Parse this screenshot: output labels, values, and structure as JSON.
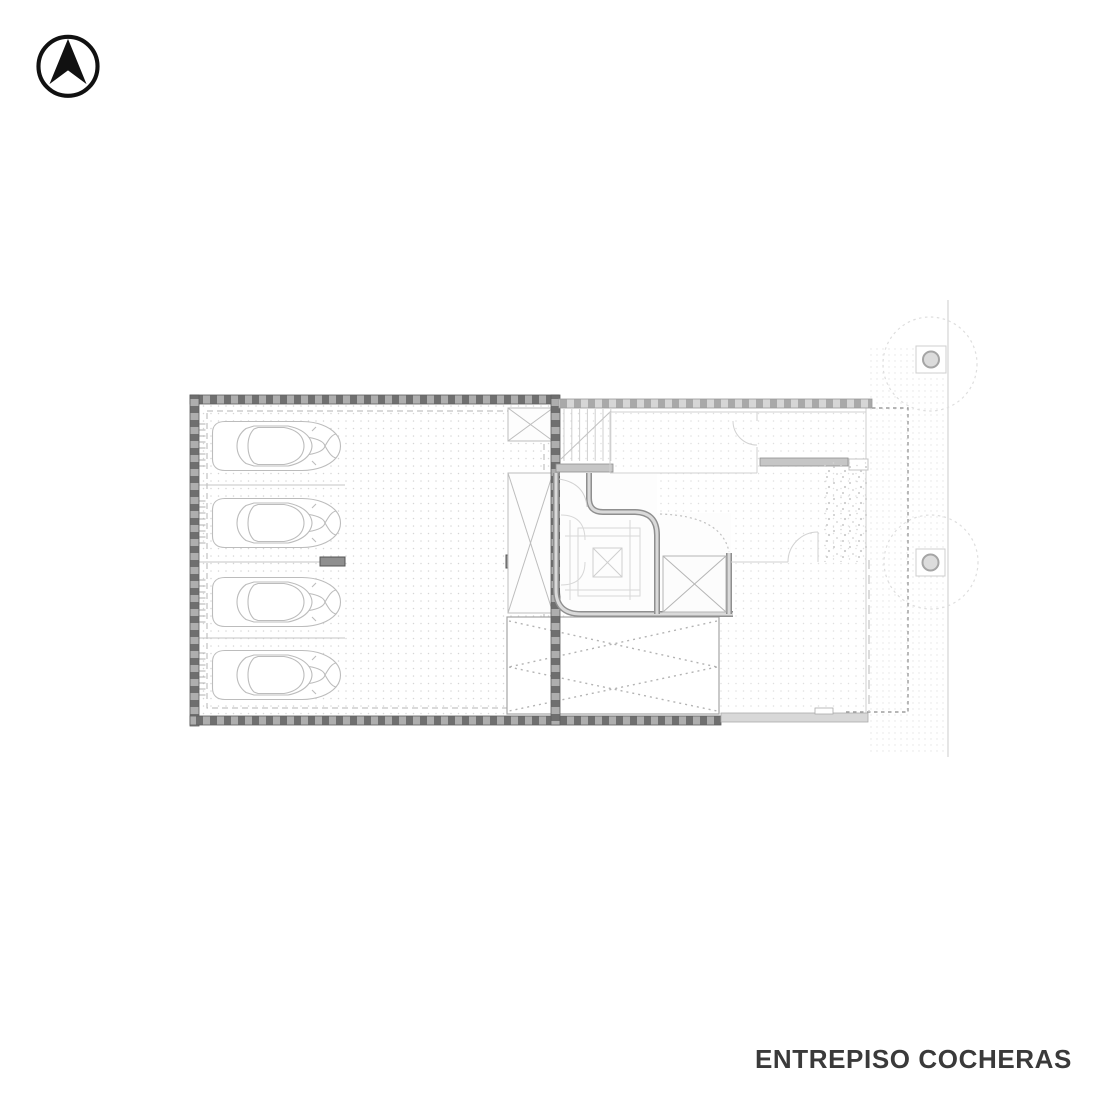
{
  "footer": {
    "title": "ENTREPISO COCHERAS"
  },
  "icons": {
    "north_arrow": "north-arrow-icon"
  },
  "colors": {
    "wall_fill": "#aeaeae",
    "wall_hatch": "#6f6f6f",
    "wall_light_fill": "#d6d6d6",
    "wall_light_hatch": "#a9a9a9",
    "wall_outline": "#5e5e5e",
    "core_wall": "#8f8f8f",
    "core_wall_inner": "#dadada",
    "faint_line": "#d2d2d2",
    "medium_line": "#b3b3b3",
    "car_line": "#bcbcbc",
    "grid_dot": "#d6d6d6",
    "grid_dot_light": "#e0e0e0",
    "grid_dot_fine": "#e4e4e4",
    "dashed_boundary": "#9d9d9d",
    "column_fill": "#8f8f8f",
    "title_color": "#3a3a3a",
    "icon_color": "#111111"
  },
  "plan": {
    "cars": {
      "count": 4,
      "x": 210,
      "ys": [
        420,
        497,
        576,
        649
      ]
    },
    "stall_dividers_y": [
      485,
      562,
      638
    ],
    "stall_line": {
      "x1": 198,
      "x2": 345
    },
    "wall_ticks": {
      "x1": 199,
      "x2": 205.5,
      "step": 6,
      "span": 46,
      "offset": 4
    },
    "stair_upper_treads": {
      "x_start": 564,
      "x_end": 611,
      "step": 7.8,
      "y1": 409,
      "y2": 461
    },
    "trees": [
      {
        "cx": 930,
        "cy": 364,
        "r": 47
      },
      {
        "cx": 931,
        "cy": 562,
        "r": 47
      }
    ],
    "posts": [
      {
        "x": 916,
        "y": 346,
        "w": 30,
        "h": 27
      },
      {
        "x": 916,
        "y": 549,
        "w": 29,
        "h": 27
      }
    ],
    "columns": [
      {
        "x": 320,
        "y": 557,
        "w": 25,
        "h": 9
      },
      {
        "x": 506,
        "y": 555,
        "w": 13,
        "h": 13
      }
    ],
    "areas": {
      "garage": "cochera",
      "ramp": "rampa",
      "stair": "escalera",
      "elevator": "ascensor",
      "sidewalk": "vereda",
      "garden": "cantero"
    }
  }
}
